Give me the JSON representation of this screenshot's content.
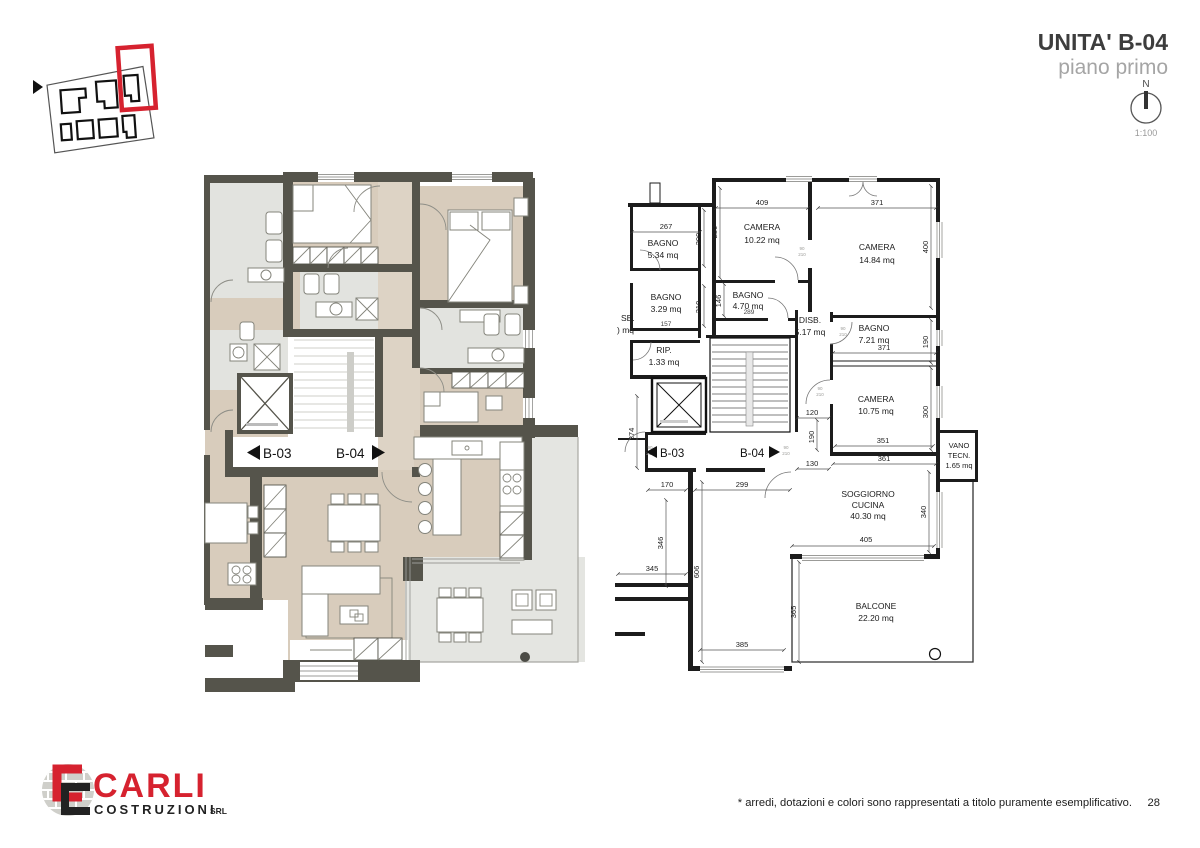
{
  "header": {
    "title": "UNITA' B-04",
    "subtitle": "piano primo"
  },
  "north": {
    "label": "N",
    "scale": "1:100"
  },
  "footer": {
    "note": "* arredi, dotazioni e colori sono rappresentati a titolo puramente esemplificativo.",
    "page": "28"
  },
  "logo": {
    "name": "CARLI",
    "subname": "COSTRUZIONI",
    "suffix": "SRL"
  },
  "corridor": {
    "left_unit": "B-03",
    "right_unit": "B-04"
  },
  "rooms": {
    "bagno534": {
      "name": "BAGNO",
      "area": "5.34 mq"
    },
    "camera1022": {
      "name": "CAMERA",
      "area": "10.22 mq"
    },
    "camera1484": {
      "name": "CAMERA",
      "area": "14.84 mq"
    },
    "bagno470": {
      "name": "BAGNO",
      "area": "4.70 mq"
    },
    "bagno329": {
      "name": "BAGNO",
      "area": "3.29 mq"
    },
    "disb517": {
      "name": "DISB.",
      "area": "5.17 mq"
    },
    "rip133": {
      "name": "RIP.",
      "area": "1.33 mq"
    },
    "bagno721": {
      "name": "BAGNO",
      "area": "7.21 mq"
    },
    "camera1075": {
      "name": "CAMERA",
      "area": "10.75 mq"
    },
    "vano": {
      "l1": "VANO",
      "l2": "TECN.",
      "l3": "1.65 mq"
    },
    "soggiorno": {
      "l1": "SOGGIORNO",
      "l2": "CUCINA",
      "l3": "40.30 mq"
    },
    "balcone": {
      "name": "BALCONE",
      "area": "22.20 mq"
    },
    "cropped": {
      "l1": "SB.",
      "l2": ") mq"
    }
  },
  "dims": {
    "d267": "267",
    "d409": "409",
    "d371a": "371",
    "d250": "250",
    "d400": "400",
    "d200": "200",
    "d210": "210",
    "d146": "146",
    "d289": "289",
    "d157": "157",
    "d371b": "371",
    "d190a": "190",
    "d120": "120",
    "d190b": "190",
    "d351": "351",
    "d361": "361",
    "d300": "300",
    "d130": "130",
    "d274": "274",
    "d170": "170",
    "d299": "299",
    "d346": "346",
    "d345": "345",
    "d606": "606",
    "d405": "405",
    "d340": "340",
    "d385": "385",
    "d365": "365"
  },
  "door_tag": {
    "w": "90",
    "h": "210"
  },
  "colors": {
    "wall": "#55544b",
    "floor": "#d8ccbc",
    "bath": "#e2e3df",
    "balcony": "#e4e5e1",
    "accent_red": "#d6222f",
    "line": "#1c1c1c"
  }
}
